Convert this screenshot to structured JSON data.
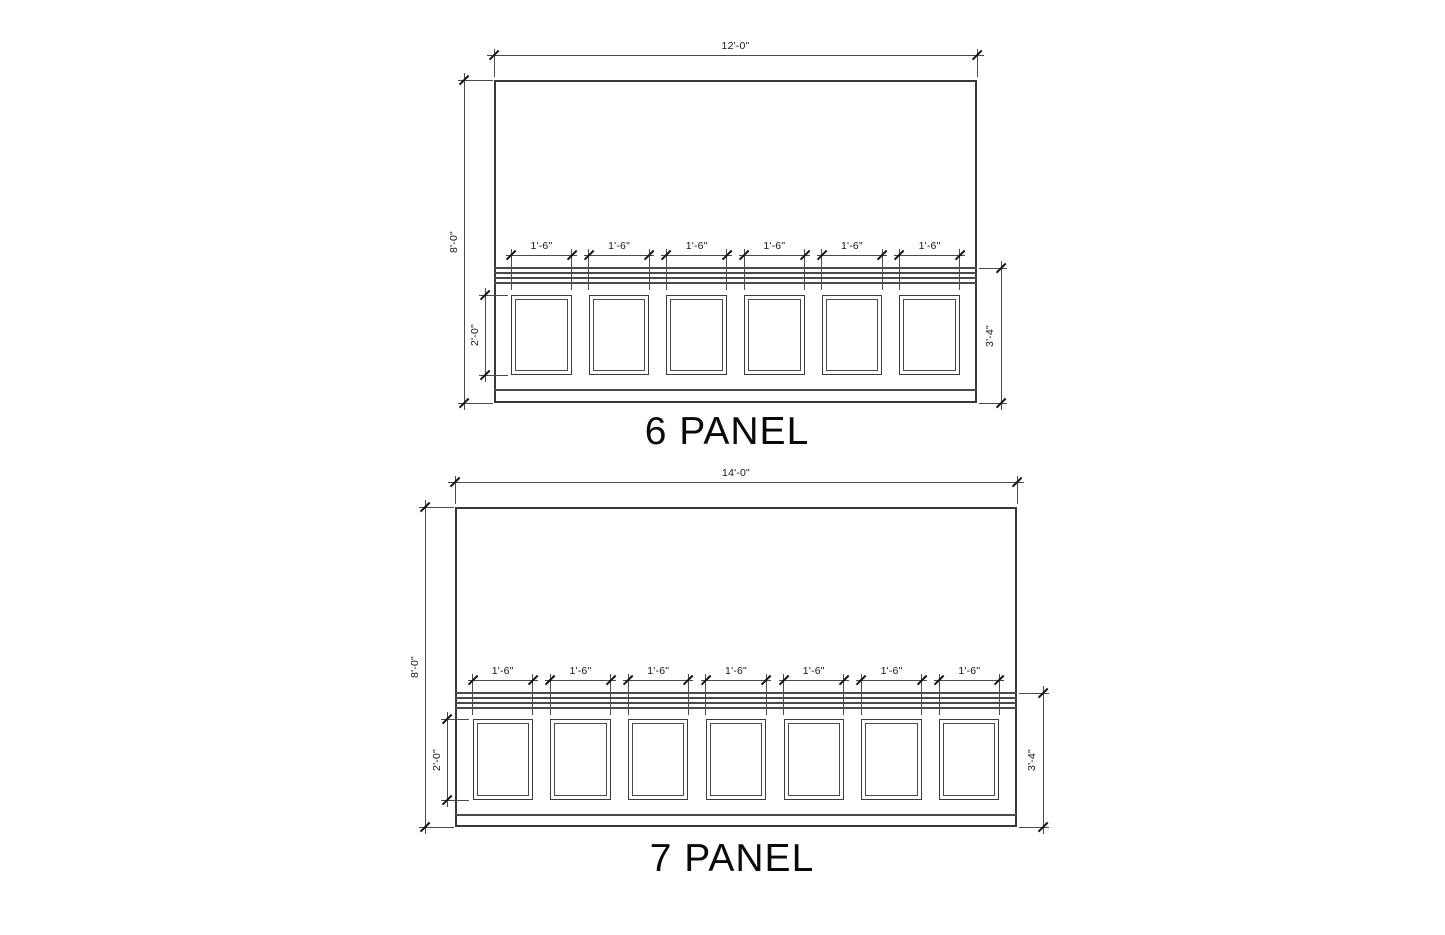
{
  "page": {
    "background": "#ffffff",
    "line_color": "#3d3d3d",
    "text_color": "#161616"
  },
  "drawings": [
    {
      "id": "6-panel",
      "title": "6 PANEL",
      "panel_count": 6,
      "dimensions": {
        "wall_width": "12'-0\"",
        "wall_height": "8'-0\"",
        "panel_width": "1'-6\"",
        "panel_height": "2'-0\"",
        "wainscot_height": "3'-4\""
      }
    },
    {
      "id": "7-panel",
      "title": "7 PANEL",
      "panel_count": 7,
      "dimensions": {
        "wall_width": "14'-0\"",
        "wall_height": "8'-0\"",
        "panel_width": "1'-6\"",
        "panel_height": "2'-0\"",
        "wainscot_height": "3'-4\""
      }
    }
  ]
}
